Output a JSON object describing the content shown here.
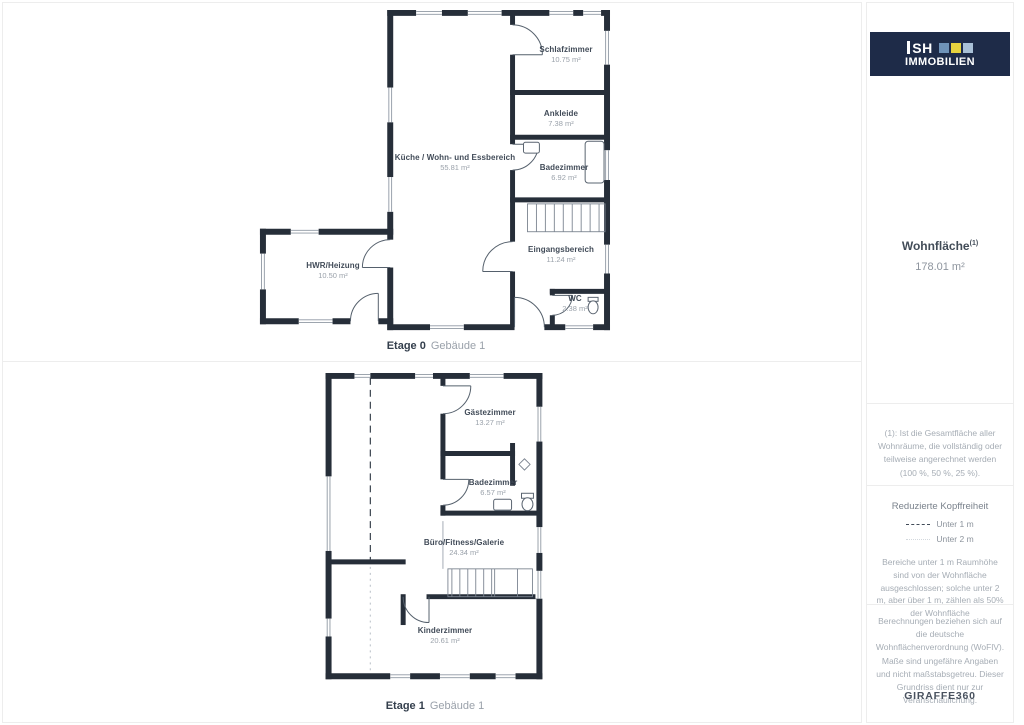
{
  "floors": [
    {
      "caption_bold": "Etage 0",
      "caption_muted": "Gebäude 1",
      "rooms": [
        {
          "name": "Küche / Wohn- und Essbereich",
          "area": "55.81 m²"
        },
        {
          "name": "Schlafzimmer",
          "area": "10.75 m²"
        },
        {
          "name": "Ankleide",
          "area": "7.38 m²"
        },
        {
          "name": "Badezimmer",
          "area": "6.92 m²"
        },
        {
          "name": "Eingangsbereich",
          "area": "11.24 m²"
        },
        {
          "name": "WC",
          "area": "2.38 m²"
        },
        {
          "name": "HWR/Heizung",
          "area": "10.50 m²"
        }
      ]
    },
    {
      "caption_bold": "Etage 1",
      "caption_muted": "Gebäude 1",
      "rooms": [
        {
          "name": "Gästezimmer",
          "area": "13.27 m²"
        },
        {
          "name": "Badezimmer",
          "area": "6.57 m²"
        },
        {
          "name": "Büro/Fitness/Galerie",
          "area": "24.34 m²"
        },
        {
          "name": "Kinderzimmer",
          "area": "20.61 m²"
        }
      ]
    }
  ],
  "sidebar": {
    "logo": {
      "name": "ISH IMMOBILIEN",
      "text_top": "SH",
      "text_bottom": "IMMOBILIEN"
    },
    "area": {
      "label": "Wohnfläche",
      "sup": "(1)",
      "value": "178.01 m²"
    },
    "footnote": "(1): Ist die Gesamtfläche aller Wohnräume, die vollständig oder teilweise angerechnet werden (100 %, 50 %, 25 %).",
    "kopffreiheit": {
      "title": "Reduzierte Kopffreiheit",
      "legend": [
        {
          "label": "Unter 1 m"
        },
        {
          "label": "Unter 2 m"
        }
      ],
      "note": "Bereiche unter 1 m Raumhöhe sind von der Wohnfläche ausgeschlossen; solche unter 2 m, aber über 1 m, zählen als 50% der Wohnfläche"
    },
    "disclaimer": "Berechnungen beziehen sich auf die deutsche Wohnflächenverordnung (WoFlV). Maße sind ungefähre Angaben und nicht maßstabsgetreu. Dieser Grundriss dient nur zur Veranschaulichung.",
    "brand": "GIRAFFE360"
  },
  "colors": {
    "wall": "#262e39",
    "logo_navy": "#1e2b48",
    "logo_steelblue": "#6f93b8",
    "logo_yellow": "#e6d23e",
    "logo_lightblue": "#a9c0d6",
    "text_dark": "#3c4653",
    "text_muted": "#9aa1aa",
    "border": "#ededed"
  }
}
